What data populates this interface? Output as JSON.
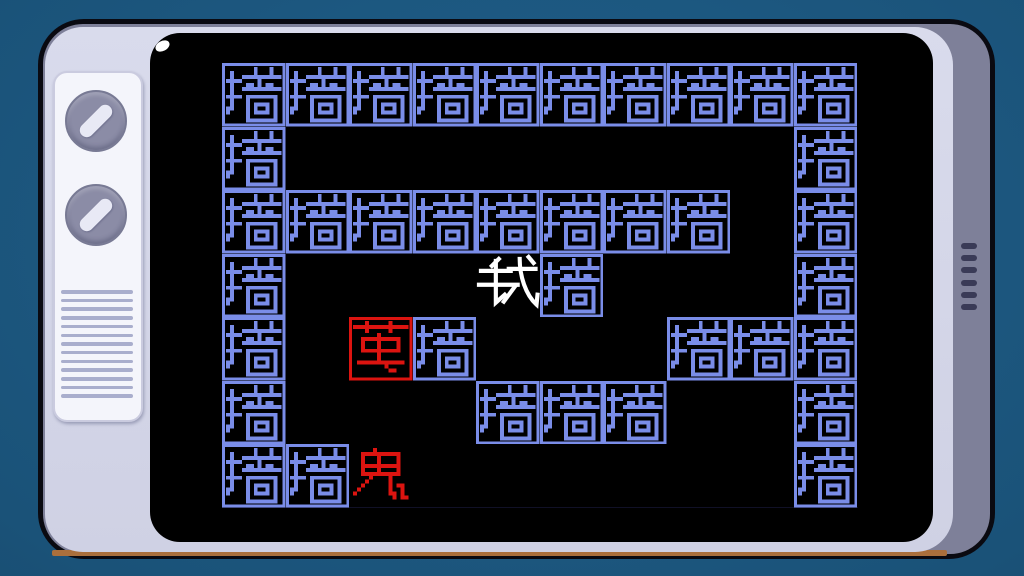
{
  "colors": {
    "background": "#1a5278",
    "tv_outline": "#0a0a11",
    "tv_face": "#d3d5e8",
    "tv_side": "#7e8099",
    "tv_accent_stripe": "#aa6f3c",
    "panel": "#f4f5fb",
    "knob": "#8b8ca6",
    "knob_pointer": "#e8e9f5",
    "grille_line": "#a9aecd",
    "vent_slot": "#3a3b57",
    "screen": "#000000",
    "screen_reflection": "#ffffff",
    "wall": "#7a8de8",
    "enemy": "#dc1410",
    "player": "#ffffff",
    "board_baseline": "#1d1d45"
  },
  "tv": {
    "knob_count": 2,
    "grille_line_count": 13,
    "vent_slot_count": 6
  },
  "game": {
    "rows": 7,
    "cols": 10,
    "grid": [
      "WWWWWWWWWW",
      "W........W",
      "WWWWWWWW.W",
      "W...PW...W",
      "W.CW...WWW",
      "W...WWW..W",
      "WWG......W"
    ],
    "legend": {
      "W": "wall",
      "P": "player",
      "C": "cocoon",
      "G": "ghost",
      ".": "empty"
    },
    "entities": {
      "wall": {
        "char": "墙",
        "color": "#7a8de8",
        "boxed": true
      },
      "player": {
        "char": "我",
        "color": "#ffffff",
        "boxed": false
      },
      "cocoon": {
        "char": "茧",
        "color": "#dc1410",
        "boxed": true
      },
      "ghost": {
        "char": "鬼",
        "color": "#dc1410",
        "boxed": false
      }
    }
  }
}
